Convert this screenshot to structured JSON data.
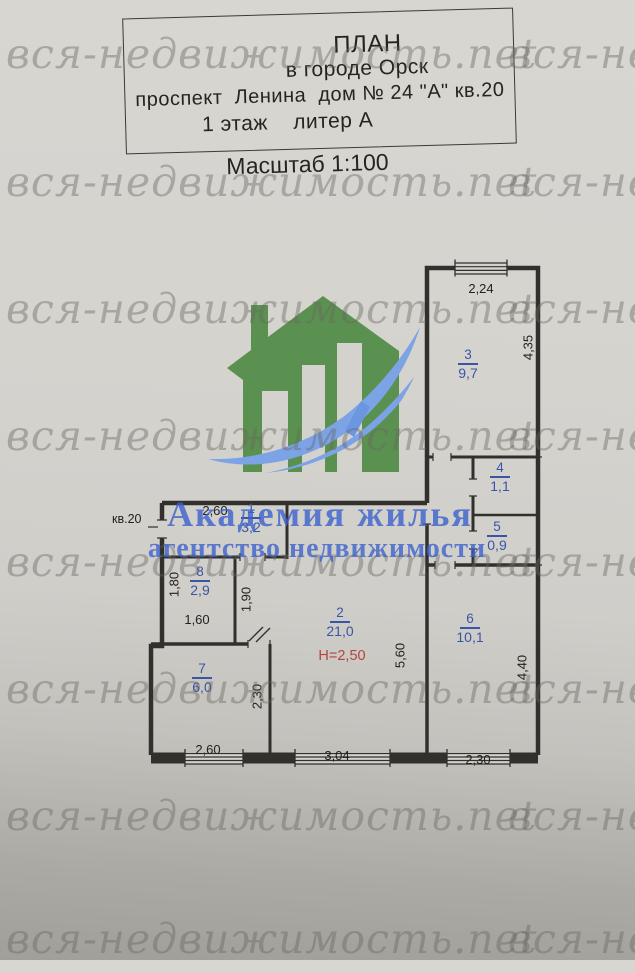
{
  "watermark": {
    "text": "вся-недвижимость.net"
  },
  "title_block": {
    "l1": "ПЛАН",
    "l2": "в городе Орск",
    "l3": "проспект  Ленина  дом № 24 \"А\" кв.20",
    "l4": "1 этаж    литер А"
  },
  "scale_label": "Масштаб 1:100",
  "agency": {
    "name": "Академия жилья",
    "tagline": "агентство недвижимости"
  },
  "plan": {
    "apartment_label": "кв.20",
    "rooms": {
      "r1": {
        "num": "1",
        "area": "3,2"
      },
      "r2": {
        "num": "2",
        "area": "21,0",
        "height": "Н=2,50"
      },
      "r3": {
        "num": "3",
        "area": "9,7"
      },
      "r4": {
        "num": "4",
        "area": "1,1"
      },
      "r5": {
        "num": "5",
        "area": "0,9"
      },
      "r6": {
        "num": "6",
        "area": "10,1"
      },
      "r7": {
        "num": "7",
        "area": "6,0"
      },
      "r8": {
        "num": "8",
        "area": "2,9"
      }
    },
    "dims": {
      "room3_top": "2,24",
      "room3_right": "4,35",
      "room1_top": "2,60",
      "room8_left": "1,80",
      "room8_bottom": "1,60",
      "corridor_right": "1,90",
      "room7_right": "2,30",
      "room7_bottom": "2,60",
      "room2_bottom": "3,04",
      "room2_right": "5,60",
      "room6_bottom": "2,30",
      "room6_right": "4,40"
    }
  },
  "colors": {
    "paper": "#d4d2cd",
    "logo_green": "#5b9150",
    "logo_blue": "#7ba3e6",
    "agency_blue": "#3a60cd",
    "room_label_blue": "#3a55a8",
    "height_red": "#b5443f",
    "line_dark": "#32302c",
    "watermark_gray": "#686762"
  }
}
